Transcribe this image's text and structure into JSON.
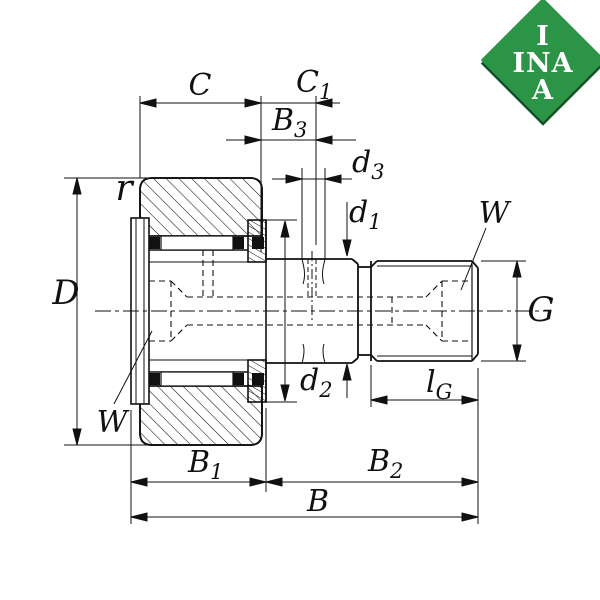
{
  "title": "Cam follower bearing cross-section drawing",
  "logo": {
    "line1": "I",
    "line2": "INA",
    "line3": "A"
  },
  "colors": {
    "line": "#111111",
    "logo_green": "#2B9447",
    "logo_shadow": "#14522A",
    "logo_text": "#ffffff",
    "background": "#ffffff"
  },
  "dimensions": {
    "C": {
      "base": "C"
    },
    "C1": {
      "base": "C",
      "sub": "1"
    },
    "B3": {
      "base": "B",
      "sub": "3"
    },
    "d3": {
      "base": "d",
      "sub": "3"
    },
    "d1": {
      "base": "d",
      "sub": "1"
    },
    "r": {
      "base": "r"
    },
    "D": {
      "base": "D"
    },
    "W_right": {
      "base": "W"
    },
    "G": {
      "base": "G"
    },
    "d2": {
      "base": "d",
      "sub": "2"
    },
    "lG": {
      "base": "l",
      "sub": "G"
    },
    "W_left": {
      "base": "W"
    },
    "B1": {
      "base": "B",
      "sub": "1"
    },
    "B2": {
      "base": "B",
      "sub": "2"
    },
    "B": {
      "base": "B"
    }
  }
}
